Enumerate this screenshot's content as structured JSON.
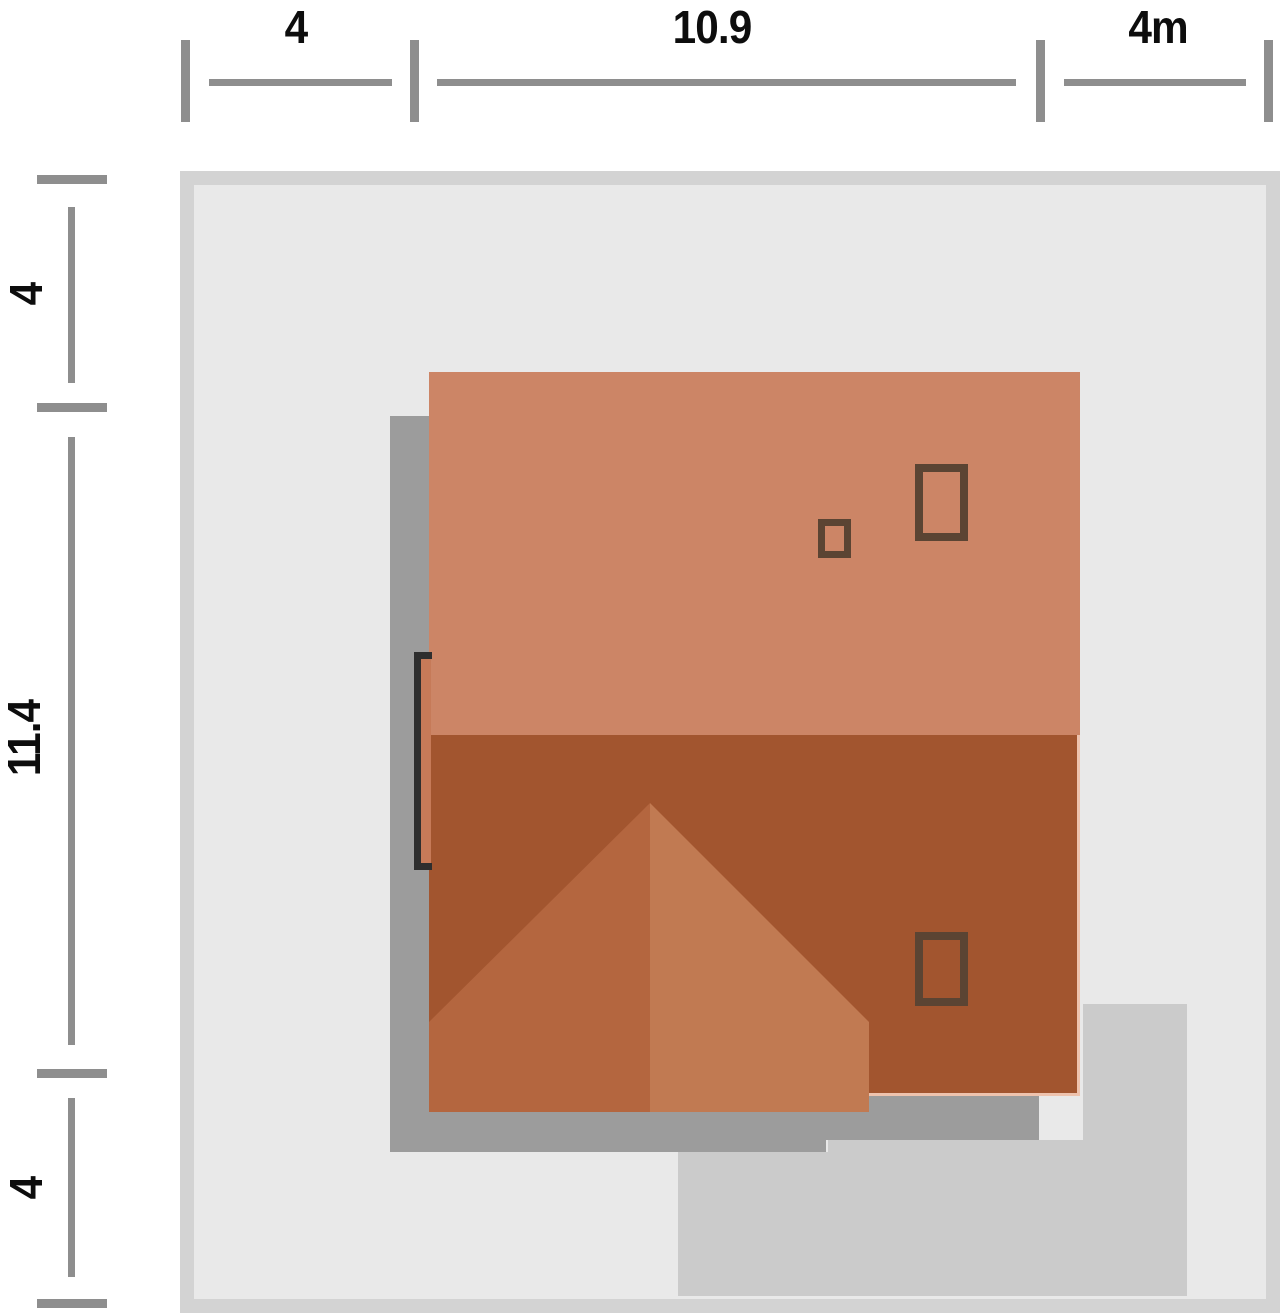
{
  "diagram": {
    "type": "site-plan-roof-view",
    "units": "m"
  },
  "dimensions": {
    "top": {
      "axis": "horizontal",
      "segments": [
        {
          "label": "4",
          "value": 4
        },
        {
          "label": "10.9",
          "value": 10.9
        },
        {
          "label": "4m",
          "value": 4
        }
      ]
    },
    "left": {
      "axis": "vertical",
      "segments": [
        {
          "label": "4",
          "value": 4
        },
        {
          "label": "11.4",
          "value": 11.4
        },
        {
          "label": "4",
          "value": 4
        }
      ]
    }
  },
  "colors": {
    "plot-border": "#d3d3d3",
    "plot-fill": "#e9e9e9",
    "underlay-gray": "#9c9c9c",
    "driveway-gray": "#cbcbcb",
    "roof-upper": "#cc8566",
    "roof-lower": "#a2552f",
    "hip-left": "#b4663f",
    "hip-right": "#c17a52",
    "roof-edge-pale": "#eec3ae",
    "chimney-outline": "#5b4433",
    "door-marker": "#2e2e2e",
    "door-leaf": "#c67a58",
    "dim-line": "#8e8e8e",
    "dim-text": "#0d0d0d"
  }
}
